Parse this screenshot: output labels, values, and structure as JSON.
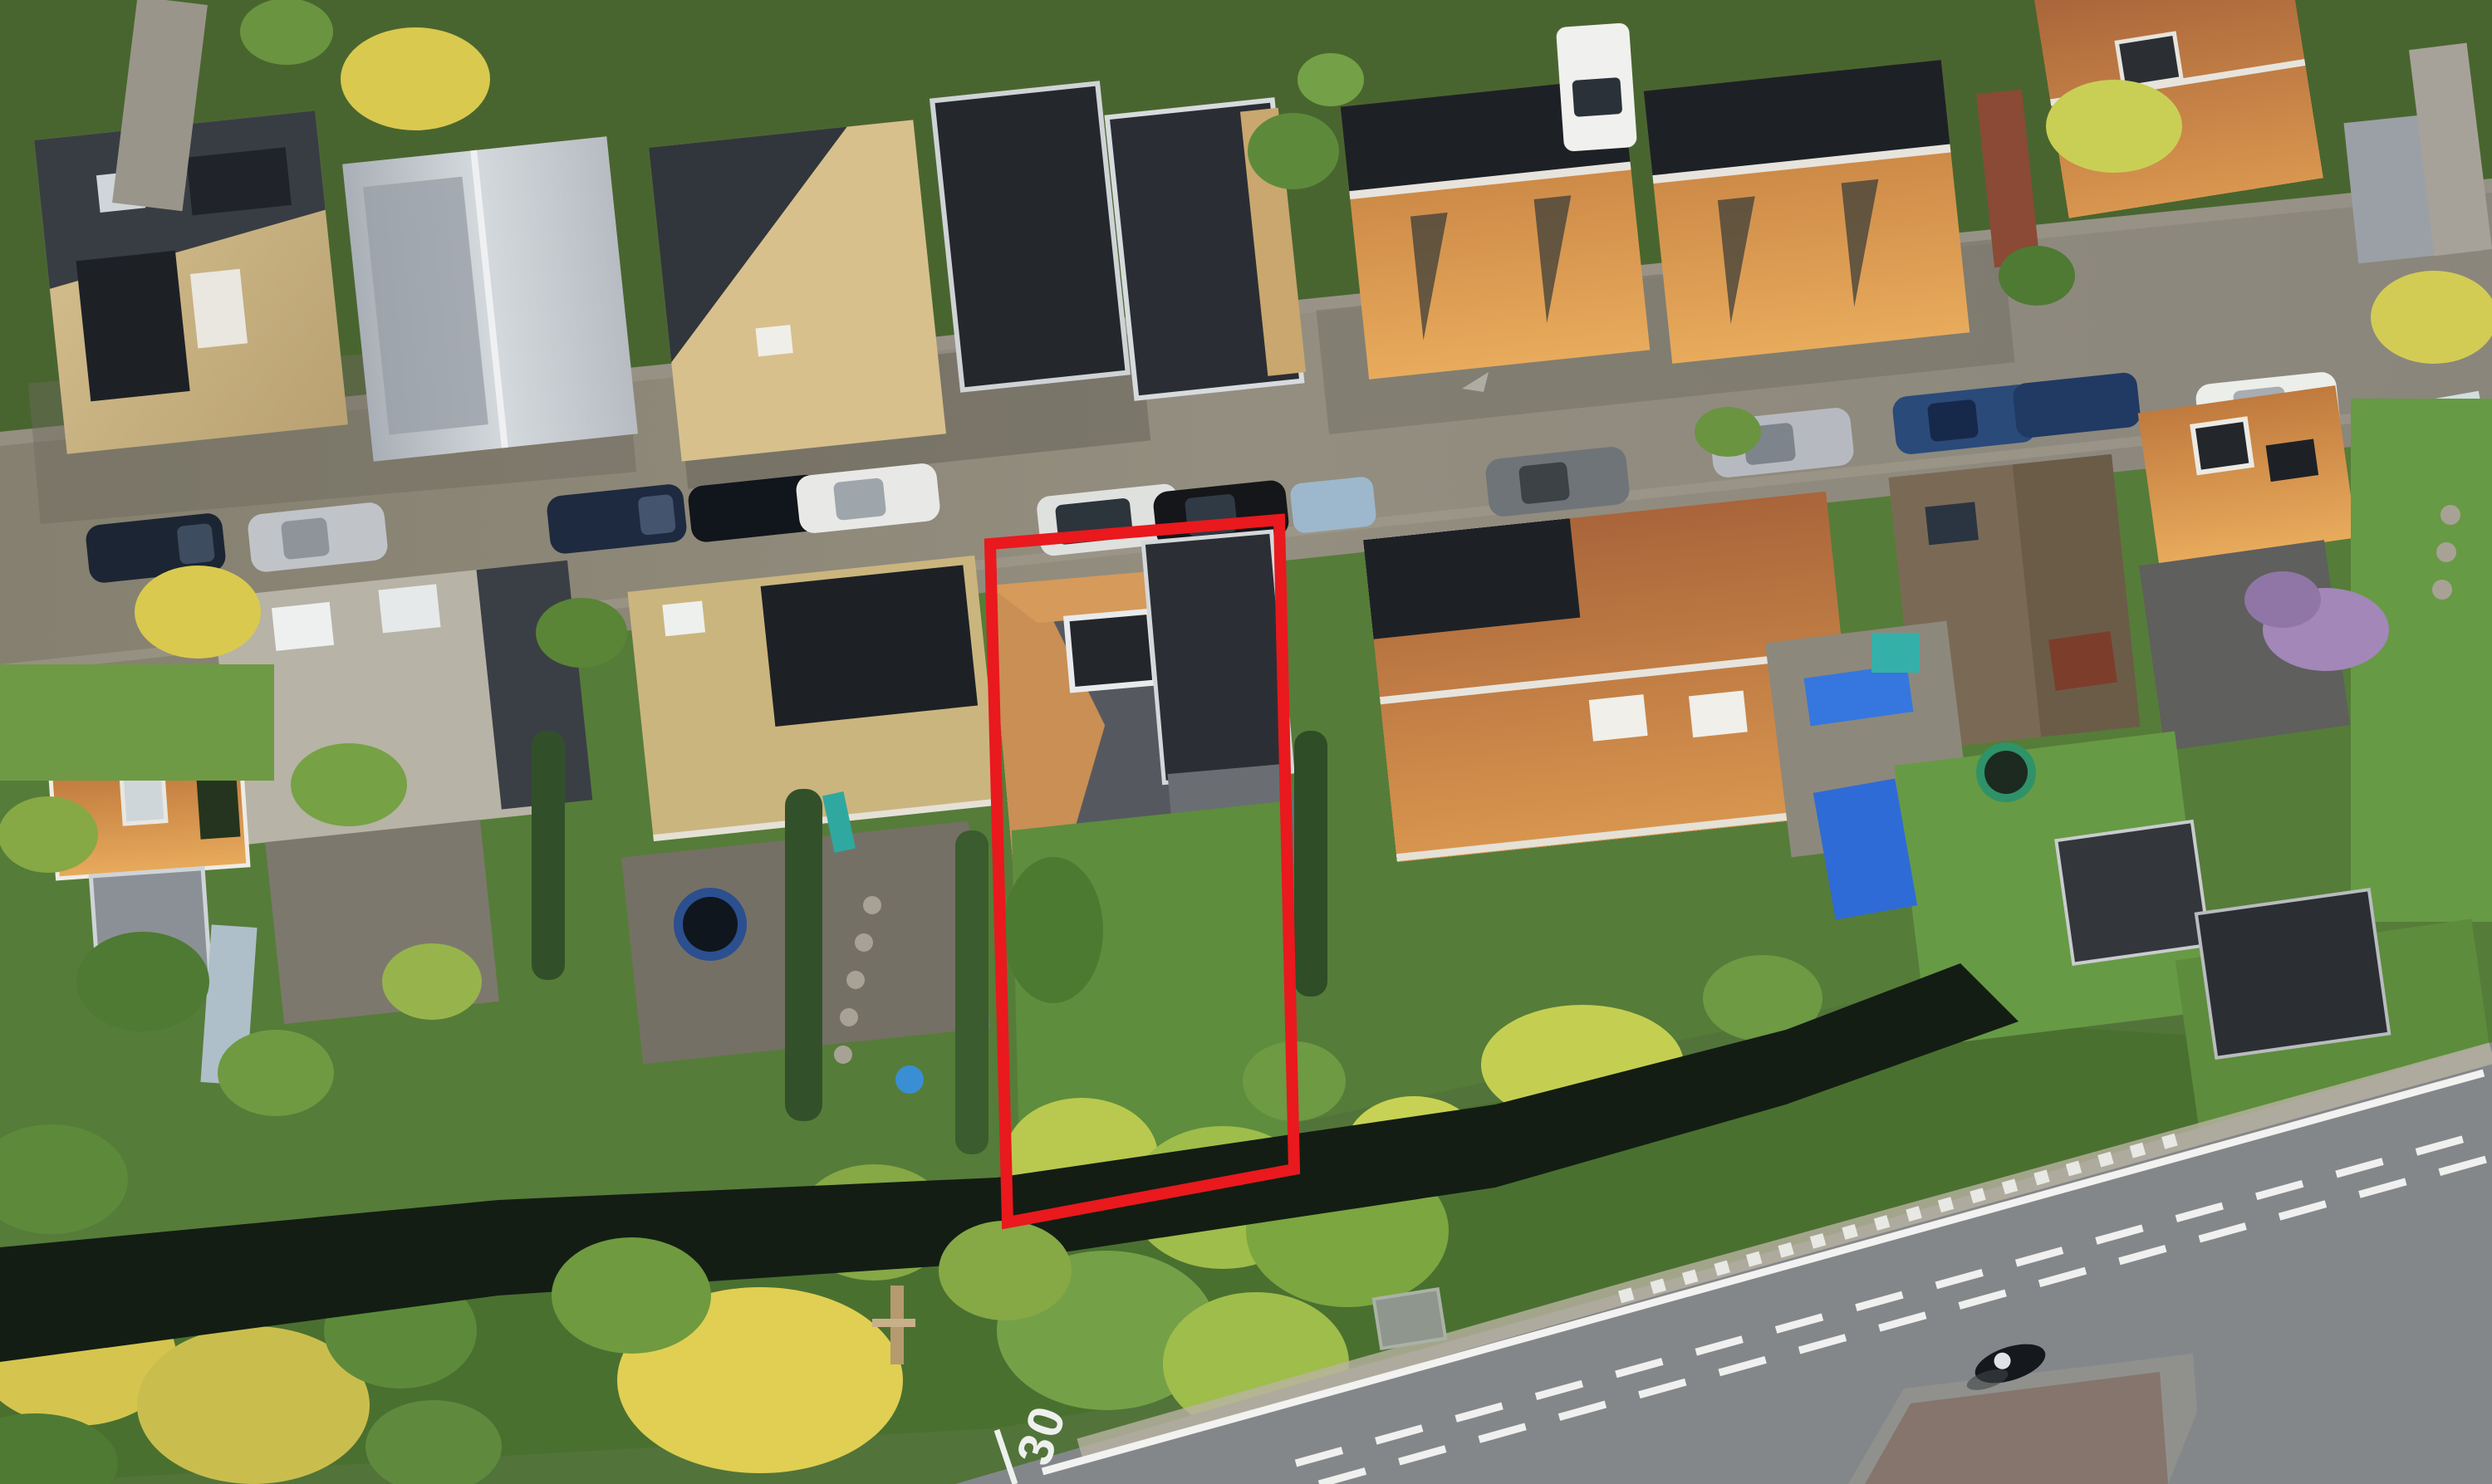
{
  "scene": {
    "type": "aerial-drone-photo",
    "road_marking_text": "30",
    "overlay_label": "property-boundary"
  },
  "palette": {
    "boundary_red": "#e9191d",
    "asphalt_street": "#8a8478",
    "asphalt_road": "#84878a",
    "canal_water": "#131d14",
    "grass_base": "#52743a",
    "lawn_bright": "#679a44",
    "roof_orange": "#bb7a43",
    "roof_orange_lit": "#d9964f",
    "roof_dark": "#26292e",
    "roof_tan": "#d3bd8d",
    "roof_silver": "#c3c8cd",
    "solar_panel": "#1d2126",
    "tarp_blue": "#2e6bd6",
    "line_white": "#f2f2f0",
    "bike_path_red": "#6e4a41"
  },
  "objects": {
    "street_cars": 13,
    "white_van": 1,
    "trampolines": 2,
    "blue_tarps": 3,
    "motorcyclist": 1,
    "utility_cabinet": 1,
    "wooden_pole": 1
  }
}
